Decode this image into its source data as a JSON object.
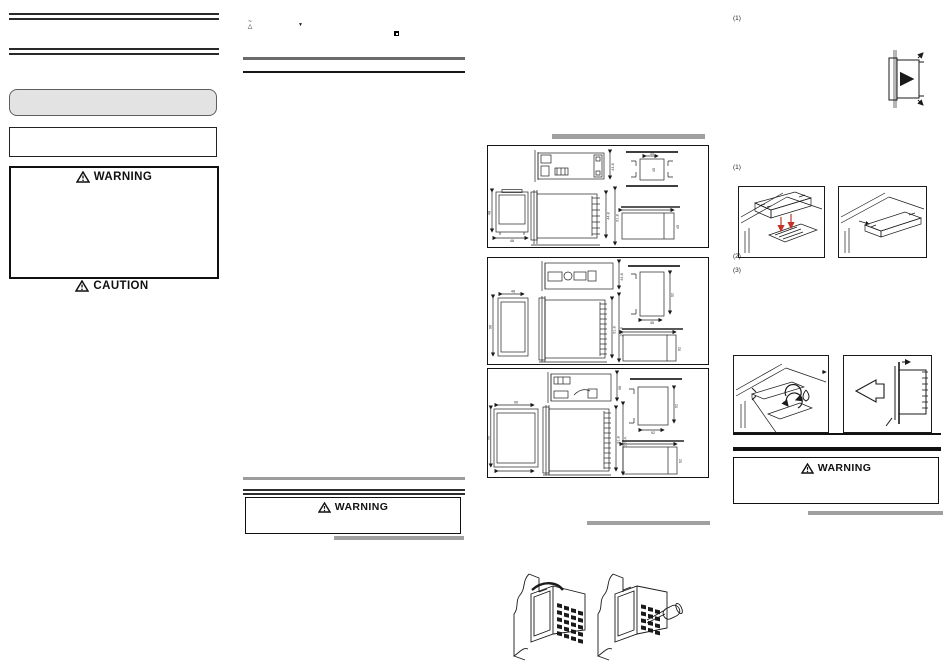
{
  "left_column": {
    "warning_box": {
      "title": "WARNING"
    },
    "caution": {
      "title": "CAUTION"
    }
  },
  "middle_column": {
    "symbols": {
      "s1_top": "~",
      "s1_bottom": "△",
      "s2": "▼"
    },
    "warning_box": {
      "title": "WARNING"
    }
  },
  "right_column": {
    "steps": [
      "(1)",
      "(1)",
      "(2)",
      "(3)"
    ],
    "warning_box": {
      "title": "WARNING"
    }
  },
  "dimension_panels": {
    "p1": {
      "d1": "44.8",
      "d2": "48",
      "d3": "48",
      "d4": "44.8",
      "d5": "91.8",
      "d6": "45",
      "d7": "45",
      "d8": "45"
    },
    "p2": {
      "d1": "44.8",
      "d2": "48",
      "d3": "96",
      "d4": "91.8",
      "d5": "107.4",
      "d6": "45",
      "d7": "92",
      "d8": "92"
    },
    "p3": {
      "d1": "96",
      "d2": "96",
      "d3": "96",
      "d4": "91.8",
      "d5": "107.4",
      "d6": "92",
      "d7": "92",
      "d8": "92"
    }
  },
  "colors": {
    "accent_red": "#c4342a",
    "bar_gray": "#9c9c9c",
    "line_black": "#1a1a1a",
    "panel_fill_gray": "#e3e3e3"
  }
}
